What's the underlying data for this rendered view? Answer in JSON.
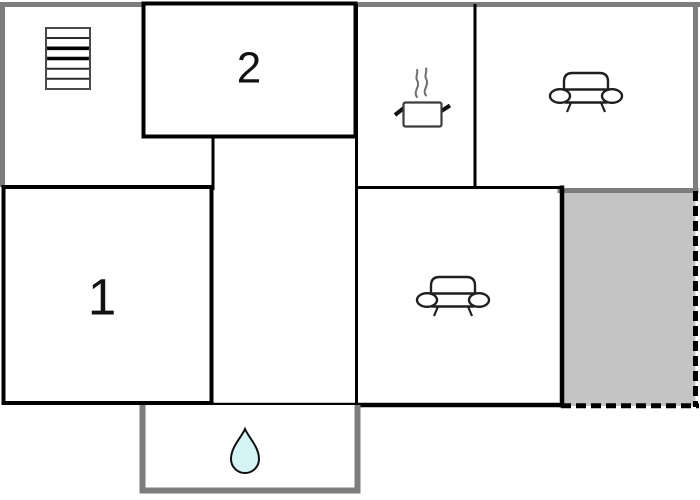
{
  "colors": {
    "background": "#ffffff",
    "wall": "#000000",
    "outer_border": "#7d7d7d",
    "room_fill": "#ffffff",
    "terrace_fill": "#c4c4c4",
    "drop_fill": "#d5f4f6",
    "label": "#111111"
  },
  "rooms": {
    "bedroom_1": {
      "label": "1"
    },
    "bedroom_2": {
      "label": "2"
    },
    "stair_room": {
      "icon": "stairs-icon"
    },
    "kitchen": {
      "icon": "cooking-pot-icon"
    },
    "living_room": {
      "icon": "sofa-icon"
    },
    "lounge": {
      "icon": "sofa-icon"
    },
    "bathroom": {
      "icon": "water-drop-icon"
    },
    "terrace": {
      "outline": "dashed"
    },
    "hallway": {}
  }
}
